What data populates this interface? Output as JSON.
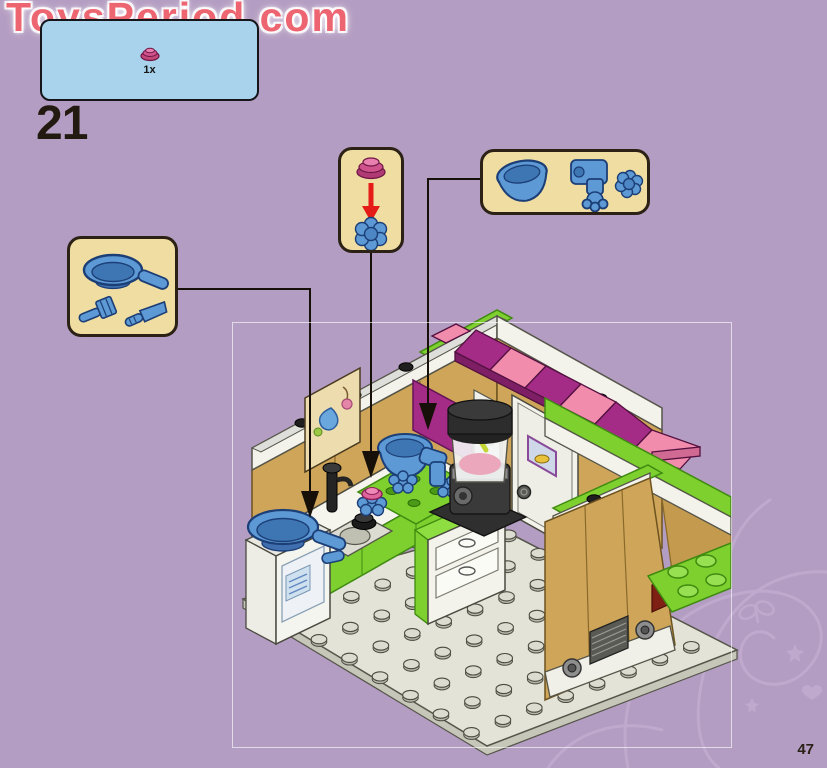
{
  "page": {
    "background_color": "#b49dc2",
    "number": "47",
    "step_number": "21"
  },
  "watermark": {
    "text": "ToysPeriod.com",
    "color": "#ed6570"
  },
  "new_parts_panel": {
    "background_color": "#a9d2ec",
    "quantity": "1x",
    "part": "dark-pink-cupcake-bowl"
  },
  "callout_boxes": [
    {
      "id": "utensils",
      "background_color": "#f0dda2",
      "parts": [
        "blue-frying-pan",
        "blue-fork",
        "blue-knife"
      ]
    },
    {
      "id": "bowl-on-flower",
      "background_color": "#f0dda2",
      "parts": [
        "dark-pink-cupcake-bowl",
        "blue-flower-plate"
      ],
      "arrow_color": "#e41b17"
    },
    {
      "id": "mixer-parts",
      "background_color": "#f0dda2",
      "parts": [
        "blue-mixing-bowl",
        "blue-mixer-arm",
        "blue-flower-plate"
      ]
    }
  ],
  "model": {
    "description": "LEGO Friends kitchen assembly step, isometric view on studded baseplate",
    "colors": {
      "lime_green": "#7ed02f",
      "tan_wall": "#cfa659",
      "magenta_awning": "#a42c87",
      "pink_awning": "#f18cad",
      "lego_blue": "#5d9ad5",
      "baseplate": "#e3e3d8"
    }
  }
}
